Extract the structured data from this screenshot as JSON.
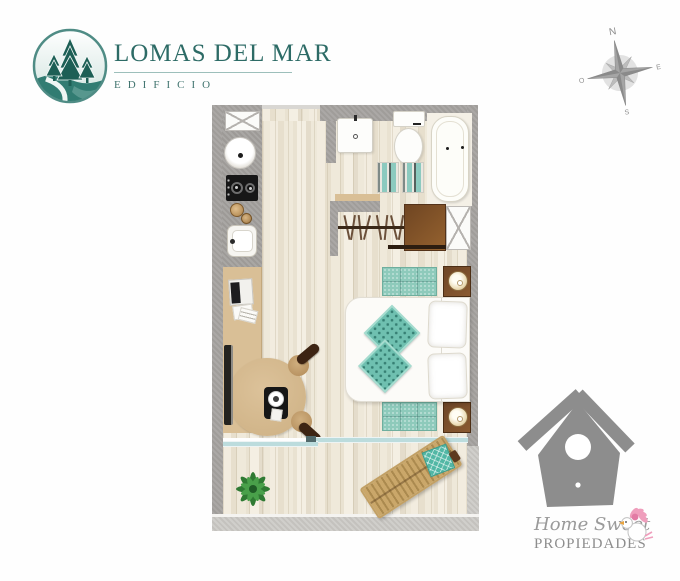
{
  "brand_lomas": {
    "title": "LOMAS DEL MAR",
    "subtitle": "EDIFICIO",
    "logo": "pine-trees-hill-circle-icon",
    "accent_color": "#2d6b66"
  },
  "compass": {
    "north": "N",
    "east": "E",
    "south": "S",
    "west": "O",
    "color": "#9c9c9c"
  },
  "floorplan": {
    "type": "studio-apartment-floor-plan",
    "palette": {
      "wall": "#a6a3a0",
      "wall_light": "#cac8c4",
      "floor_wood": "#efe8d9",
      "counter_wood": "#d9bf96",
      "teal_textile": "#8ccabf",
      "furniture_brown": "#7b4b26",
      "glass_door": "#bcdcdd"
    },
    "rooms": [
      "entry",
      "kitchen",
      "bathroom",
      "closet",
      "bedroom-living",
      "terrace"
    ],
    "furniture": [
      "vent-box",
      "round-basin",
      "cooktop",
      "bowls",
      "kitchen-sink",
      "desk-counter",
      "laptop",
      "papers",
      "tv-screen",
      "round-table",
      "dining-chairs",
      "placemat-plate",
      "washbasin",
      "toilet",
      "bathtub",
      "towels",
      "hanger-rod",
      "wardrobe-shelf",
      "storage-box",
      "rug",
      "nightstand",
      "table-lamp",
      "double-bed",
      "white-pillows",
      "teal-pillows",
      "sliding-glass-door",
      "potted-plant",
      "lounge-chair"
    ]
  },
  "brand_hsp": {
    "line1": "Home Sweet",
    "line2": "PROPIEDADES",
    "logo": "birdhouse-with-bird-icon",
    "gray": "#8d8d8d",
    "pink": "#ef9ebc"
  }
}
